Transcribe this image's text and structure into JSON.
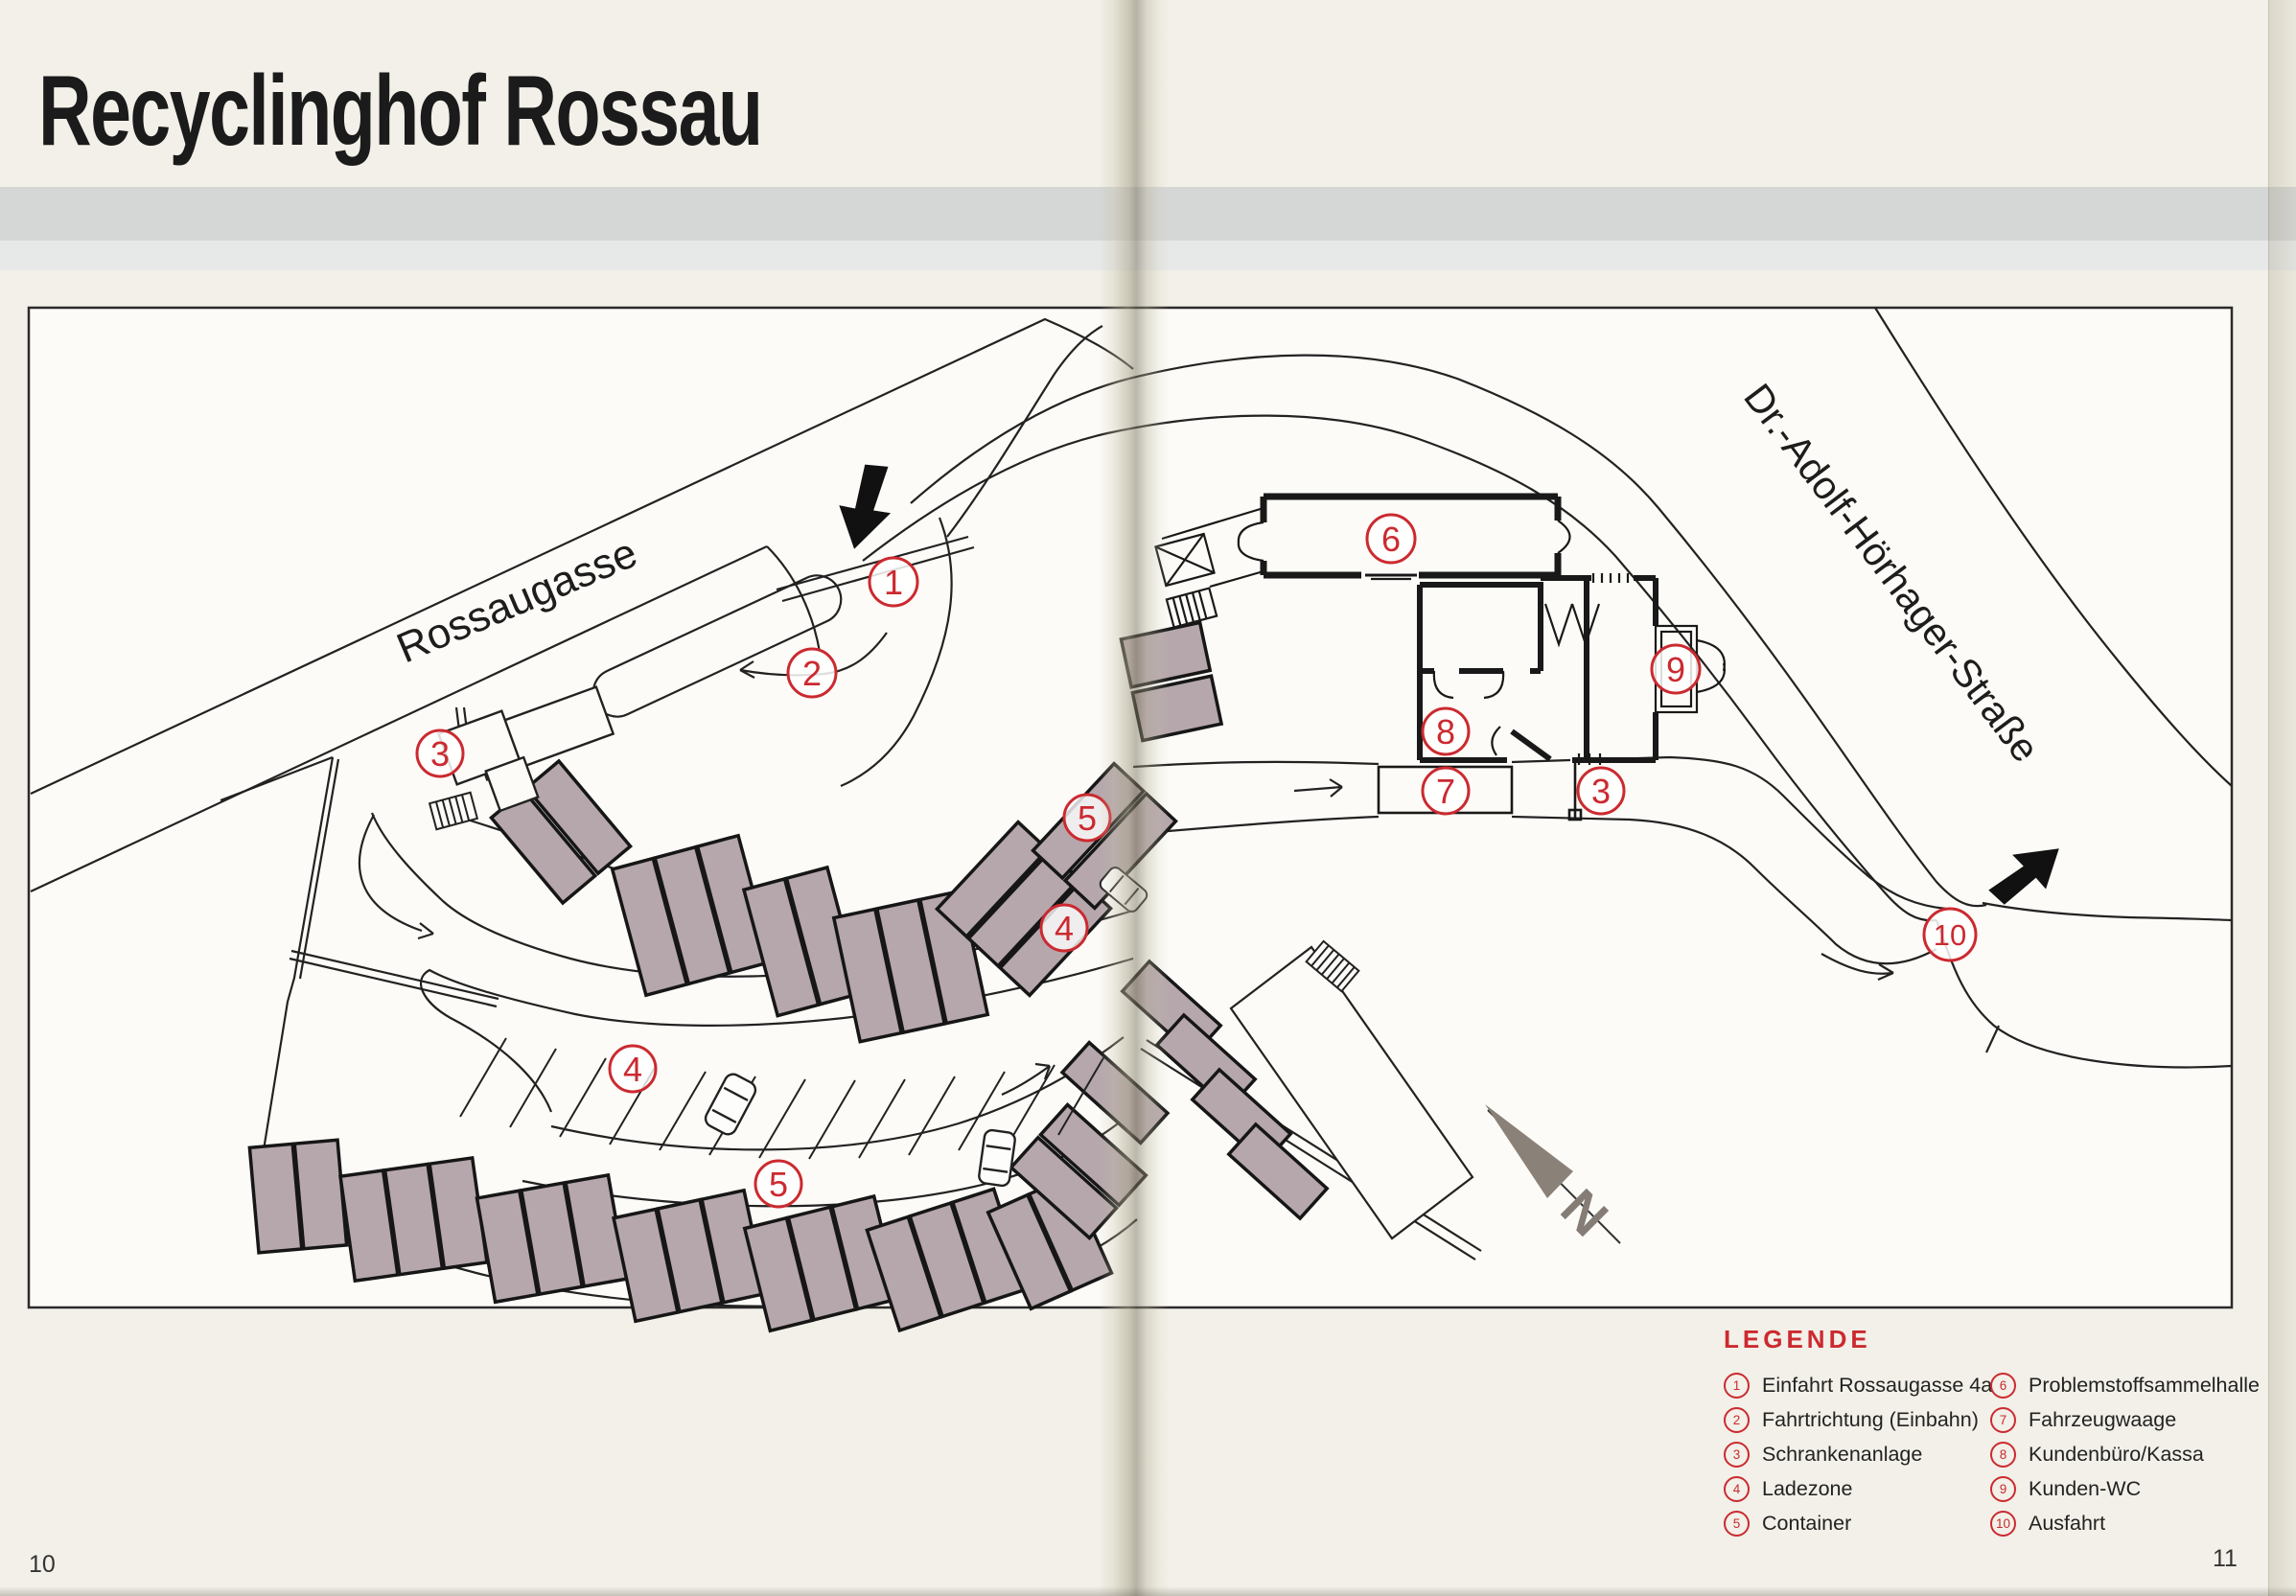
{
  "page": {
    "title": "Recyclinghof Rossau",
    "page_number_left": "10",
    "page_number_right": "11"
  },
  "map": {
    "street_labels": {
      "rossaugasse": "Rossaugasse",
      "hoerhager": "Dr.-Adolf-Hörhager-Straße"
    },
    "compass_label": "N",
    "markers": [
      {
        "label": "1"
      },
      {
        "label": "2"
      },
      {
        "label": "3"
      },
      {
        "label": "5"
      },
      {
        "label": "4"
      },
      {
        "label": "4"
      },
      {
        "label": "5"
      },
      {
        "label": "6"
      },
      {
        "label": "9"
      },
      {
        "label": "8"
      },
      {
        "label": "7"
      },
      {
        "label": "3"
      },
      {
        "label": "10"
      }
    ]
  },
  "legend": {
    "heading": "LEGENDE",
    "items": [
      {
        "number": "1",
        "label": "Einfahrt Rossaugasse 4a"
      },
      {
        "number": "2",
        "label": "Fahrtrichtung (Einbahn)"
      },
      {
        "number": "3",
        "label": "Schrankenanlage"
      },
      {
        "number": "4",
        "label": "Ladezone"
      },
      {
        "number": "5",
        "label": "Container"
      },
      {
        "number": "6",
        "label": "Problemstoffsammelhalle"
      },
      {
        "number": "7",
        "label": "Fahrzeugwaage"
      },
      {
        "number": "8",
        "label": "Kundenbüro/Kassa"
      },
      {
        "number": "9",
        "label": "Kunden-WC"
      },
      {
        "number": "10",
        "label": "Ausfahrt"
      }
    ]
  },
  "colors": {
    "accent_red": "#cb2a30",
    "container_fill": "#b5a7ac",
    "band_gray": "#d5d7d6",
    "paper": "#f2f0e8",
    "line": "#222222"
  }
}
